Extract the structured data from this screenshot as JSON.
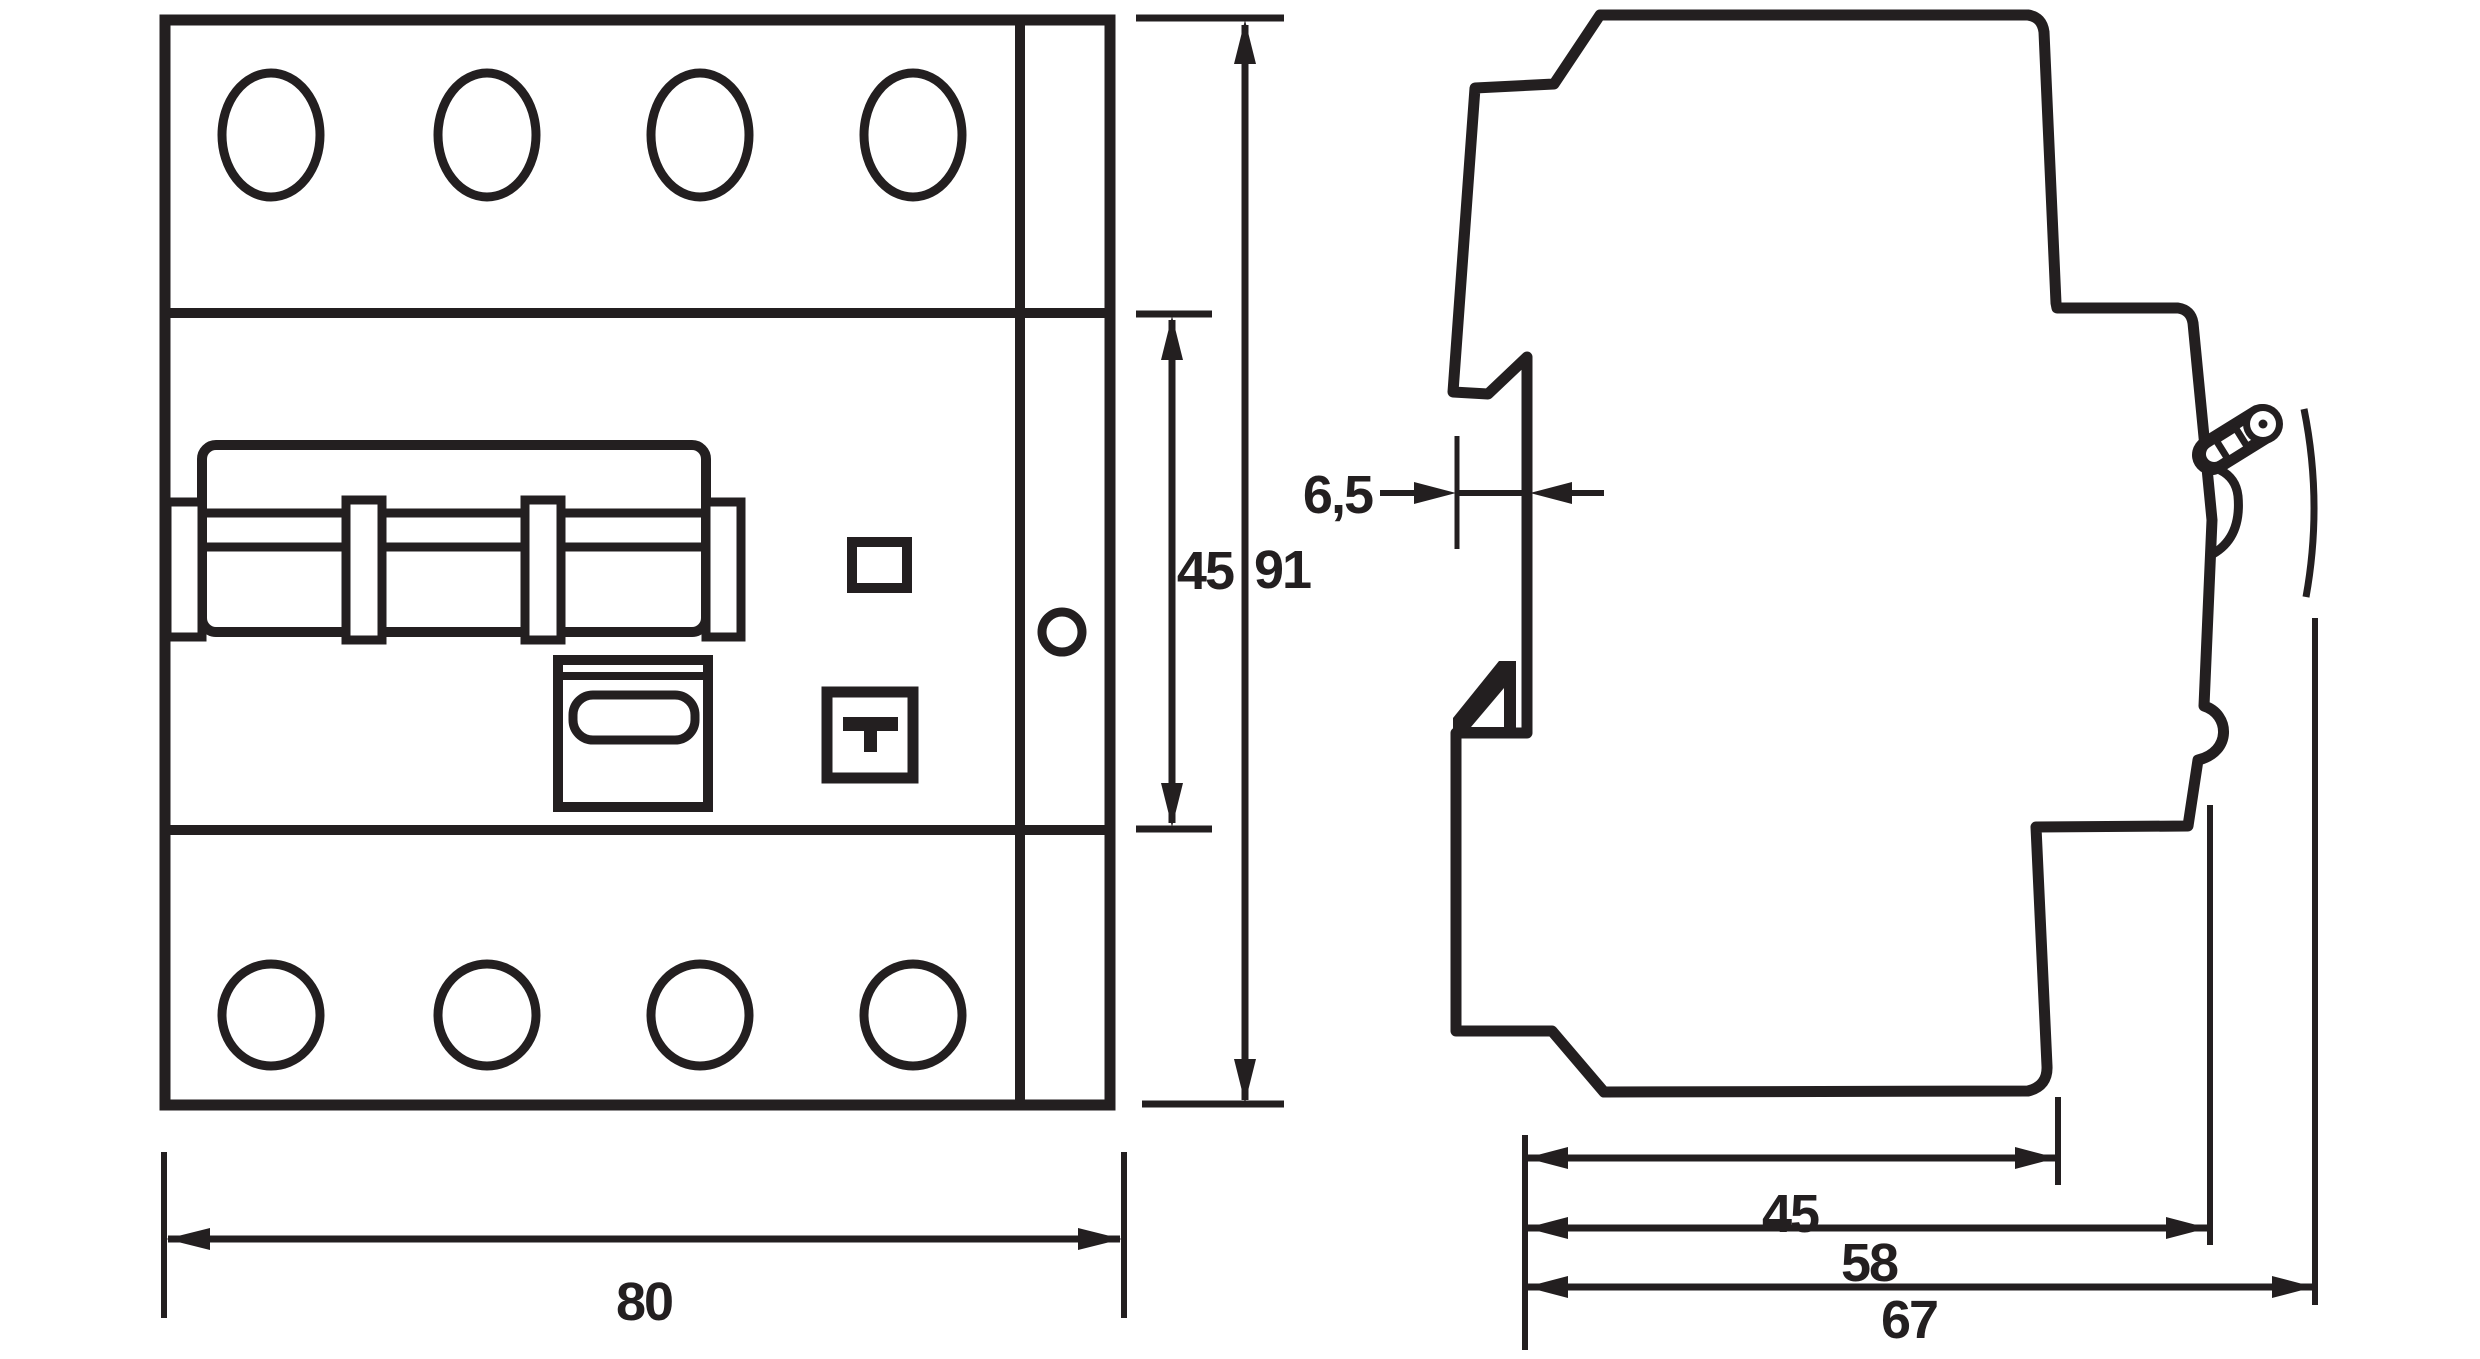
{
  "front_view": {
    "width_mm": "80",
    "module_height_mm": "45",
    "overall_height_mm": "91",
    "test_button_symbol": "T"
  },
  "side_view": {
    "recess_depth_mm": "6,5",
    "depth_front_mm": "45",
    "depth_step_mm": "58",
    "overall_depth_mm": "67"
  },
  "style": {
    "line_color": "#231f20",
    "background": "#ffffff"
  }
}
